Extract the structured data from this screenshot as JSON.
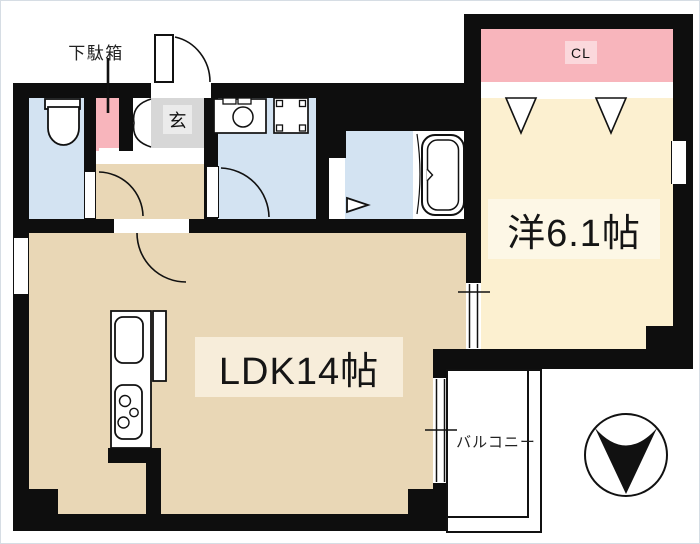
{
  "colors": {
    "wall": "#0e0e0e",
    "water-blue": "#d3e3f2",
    "ldk-tan": "#e9d7b6",
    "western-cream": "#fcf0d0",
    "closet-pink": "#f8b5bc",
    "closet-pink-light": "#fbd8dc",
    "genkan-gray": "#d7d7d7",
    "genkan-gray-light": "#ebebeb",
    "band-tan": "#f7edda",
    "band-cream": "#fdf7e6"
  },
  "labels": {
    "shoe_cabinet": "下駄箱",
    "entrance": "玄",
    "closet": "CL",
    "western_room": "洋6.1帖",
    "ldk": "LDK14帖",
    "balcony": "バルコニー"
  }
}
